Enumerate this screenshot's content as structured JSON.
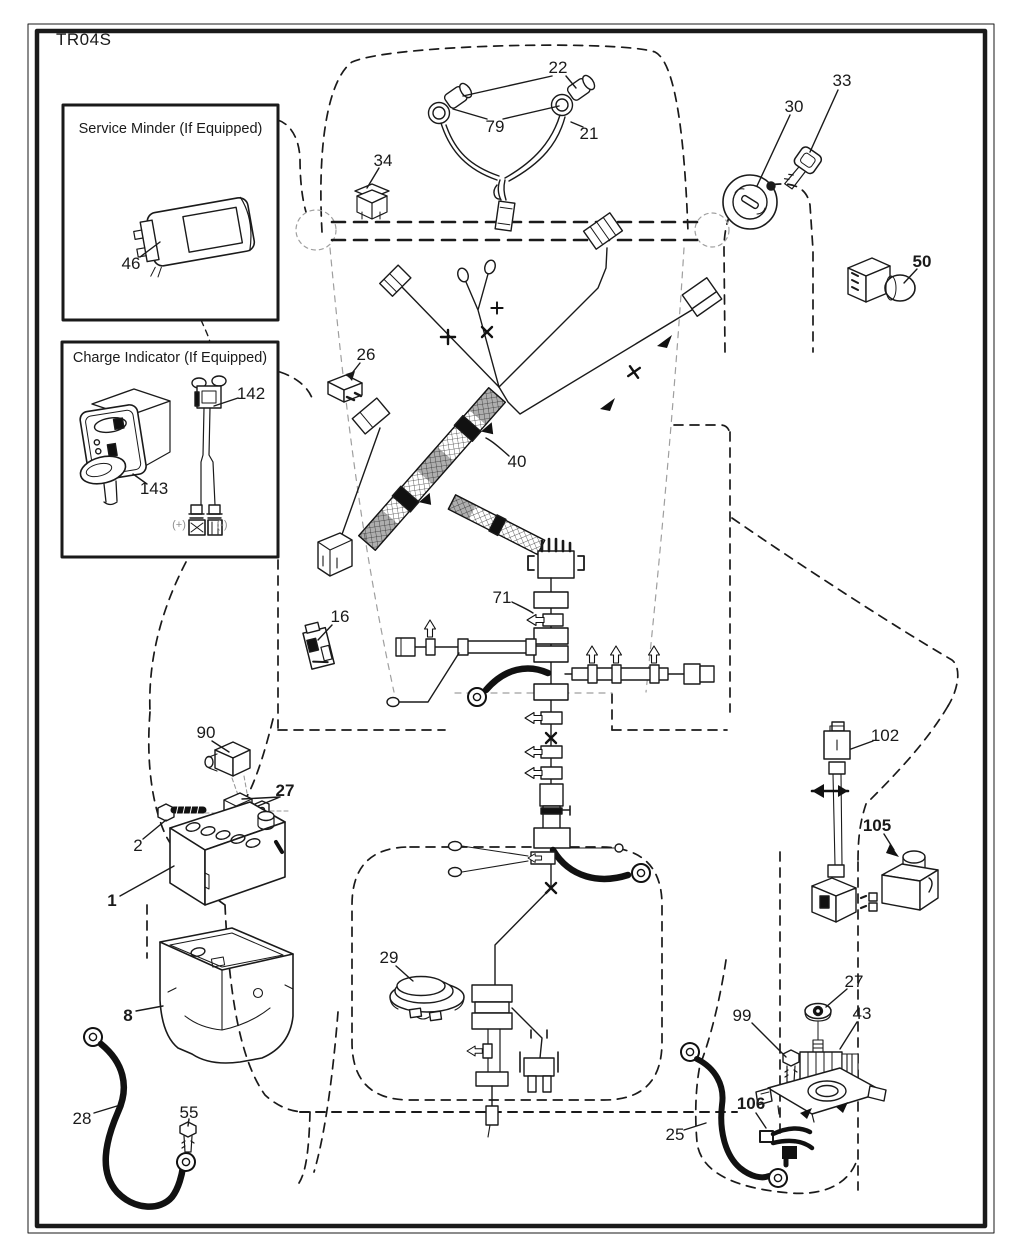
{
  "page": {
    "title": "TR04S",
    "background_color": "#ffffff",
    "line_color": "#1a1a1a",
    "muted_color": "#8f8f8f"
  },
  "insets": {
    "service_minder": {
      "title": "Service Minder (If Equipped)",
      "callout": "46"
    },
    "charge_indicator": {
      "title": "Charge Indicator (If Equipped)",
      "callout_wire": "142",
      "callout_gauge": "143",
      "positive_label": "(+)",
      "negative_label": "(-)"
    }
  },
  "callouts": [
    {
      "text": "22",
      "x": 558,
      "y": 68,
      "bold": false
    },
    {
      "text": "79",
      "x": 495,
      "y": 127,
      "bold": false
    },
    {
      "text": "21",
      "x": 589,
      "y": 134,
      "bold": false
    },
    {
      "text": "34",
      "x": 383,
      "y": 161,
      "bold": false
    },
    {
      "text": "30",
      "x": 794,
      "y": 107,
      "bold": false
    },
    {
      "text": "33",
      "x": 842,
      "y": 81,
      "bold": false
    },
    {
      "text": "50",
      "x": 922,
      "y": 262,
      "bold": true
    },
    {
      "text": "26",
      "x": 366,
      "y": 355,
      "bold": false
    },
    {
      "text": "40",
      "x": 517,
      "y": 462,
      "bold": false
    },
    {
      "text": "46",
      "x": 131,
      "y": 264,
      "bold": false
    },
    {
      "text": "142",
      "x": 251,
      "y": 394,
      "bold": false
    },
    {
      "text": "143",
      "x": 154,
      "y": 489,
      "bold": false
    },
    {
      "text": "(+)",
      "x": 179,
      "y": 525,
      "bold": false,
      "muted": true
    },
    {
      "text": "(-)",
      "x": 222,
      "y": 525,
      "bold": false,
      "muted": true
    },
    {
      "text": "16",
      "x": 340,
      "y": 617,
      "bold": false
    },
    {
      "text": "71",
      "x": 502,
      "y": 598,
      "bold": false
    },
    {
      "text": "90",
      "x": 206,
      "y": 733,
      "bold": false
    },
    {
      "text": "27",
      "x": 285,
      "y": 791,
      "bold": true
    },
    {
      "text": "2",
      "x": 138,
      "y": 846,
      "bold": false
    },
    {
      "text": "1",
      "x": 112,
      "y": 901,
      "bold": true
    },
    {
      "text": "8",
      "x": 128,
      "y": 1016,
      "bold": true
    },
    {
      "text": "29",
      "x": 389,
      "y": 958,
      "bold": false
    },
    {
      "text": "28",
      "x": 82,
      "y": 1119,
      "bold": false
    },
    {
      "text": "55",
      "x": 189,
      "y": 1113,
      "bold": false
    },
    {
      "text": "102",
      "x": 885,
      "y": 736,
      "bold": false
    },
    {
      "text": "105",
      "x": 877,
      "y": 826,
      "bold": true
    },
    {
      "text": "27",
      "x": 854,
      "y": 982,
      "bold": false
    },
    {
      "text": "43",
      "x": 862,
      "y": 1014,
      "bold": false
    },
    {
      "text": "99",
      "x": 742,
      "y": 1016,
      "bold": false
    },
    {
      "text": "106",
      "x": 751,
      "y": 1104,
      "bold": true
    },
    {
      "text": "25",
      "x": 675,
      "y": 1135,
      "bold": false
    }
  ]
}
